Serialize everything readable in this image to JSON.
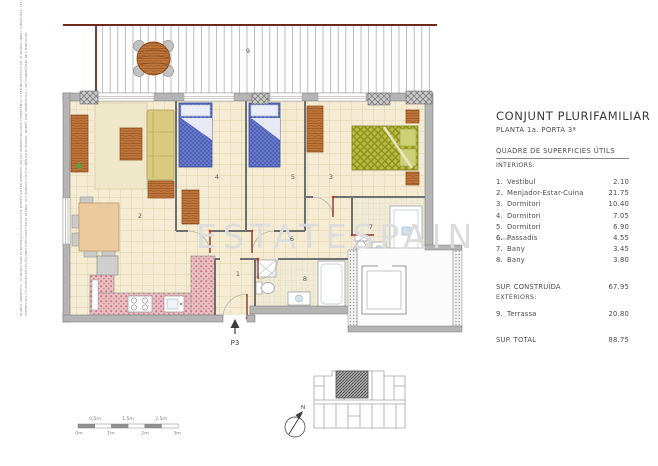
{
  "doc": {
    "panel": {
      "title": "CONJUNT PLURIFAMILIAR",
      "subtitle": "PLANTA 1a. PORTA 3ª",
      "table_title": "QUADRE DE SUPERFICIES ÚTILS",
      "interiors_heading": "INTERIORS:",
      "interiors": [
        {
          "num": "1.",
          "name": "Vestíbul",
          "area": "2.10"
        },
        {
          "num": "2.",
          "name": "Menjador-Estar-Cuina",
          "area": "21.75"
        },
        {
          "num": "3.",
          "name": "Dormitori",
          "area": "10.40"
        },
        {
          "num": "4.",
          "name": "Dormitori",
          "area": "7.05"
        },
        {
          "num": "5.",
          "name": "Dormitori",
          "area": "6.90"
        },
        {
          "num": "6.",
          "name": "Passadís",
          "area": "4.55"
        },
        {
          "num": "7.",
          "name": "Bany",
          "area": "3.45"
        },
        {
          "num": "8.",
          "name": "Bany",
          "area": "3.80"
        }
      ],
      "built_label": "SUP. CONSTRUÏDA",
      "built_value": "67.95",
      "exteriors_heading": "EXTERIORS:",
      "exteriors": [
        {
          "num": "9.",
          "name": "Terrassa",
          "area": "20.80"
        }
      ],
      "total_label": "SUP. TOTAL",
      "total_value": "88.75"
    },
    "plan": {
      "watermark": "ESTATESPAIN –",
      "labels": {
        "terrassa": "9",
        "menjador": "2",
        "dorm3": "3",
        "dorm4": "4",
        "dorm5": "5",
        "passadis": "6",
        "bany7": "7",
        "bany8": "8",
        "vestibul": "1"
      },
      "entrance_label": "P3",
      "north_label": "N"
    },
    "scalebar": {
      "top": [
        "0,5m",
        "1,5m",
        "2,5m"
      ],
      "bottom": [
        "0m",
        "1m",
        "2m",
        "3m"
      ]
    },
    "margin_note": {
      "line1": "PLANOL ORIENTATIU. LA PROMOTORA ES RESERVA LA FACULTAT DE MODIFICAR PER IMPERATIU DE LES ADMINISTRACIONS COMPETENTS, O PER NECESSITATS DE LA PROPIA OBRA I COMERCIALS, LES DISTRIBUCIONS,",
      "line2": "SUPERFICIES I FUSTERIES DE LES FAÇANES EXPOSADES EN EL PLANOL. ELS MOBLES QUE FIGUREN EN EL PLANOL, NOMÉS SON ORIENTATIUS, I NO FORMEN PART DE L'HABITATGE.",
      "date": "ABRIL, 2022"
    },
    "colors": {
      "wall_gray": "#b4b4b4",
      "bed_blue": "#4f63b8",
      "bed_green": "#b8bb3d",
      "wood": "#c0763a",
      "kitchen_pink": "#e9bec2",
      "terrace_border_maroon": "#6e2a1e",
      "tile_cream": "#f4ebd2",
      "watermark_gray": "#dcdcdc"
    }
  }
}
